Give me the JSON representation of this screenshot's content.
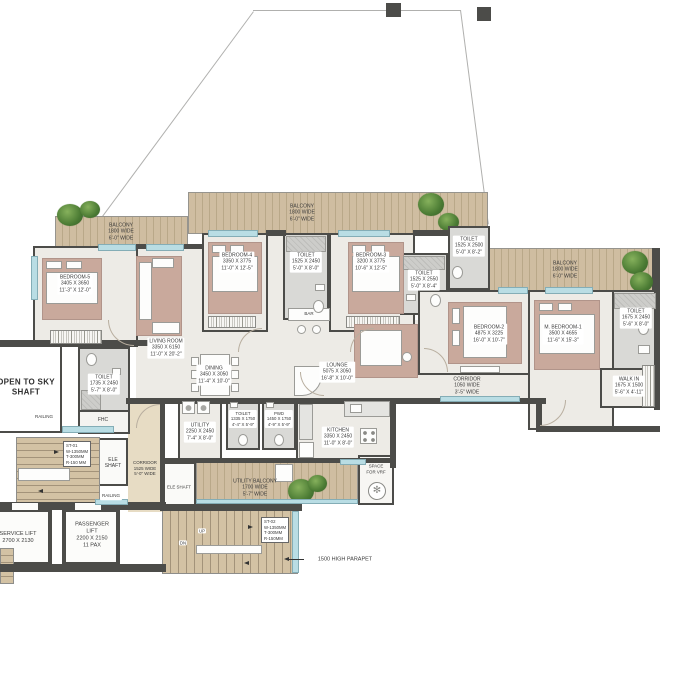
{
  "document": {
    "type": "apartment-floor-plan"
  },
  "colors": {
    "wall": "#4c4c49",
    "floor": "#edebe6",
    "tile": "#d9d9d6",
    "wood": "#cfbda1",
    "corridor_floor": "#e7dcc4",
    "furniture_rose": "#c9a99c",
    "window_glass": "#b9dde4",
    "tree_green": "#4a7a33",
    "text": "#3a3a3a"
  },
  "labels": {
    "balcony_tl": [
      "BALCONY",
      "1800 WIDE",
      "6'-0\" WIDE"
    ],
    "balcony_mid": [
      "BALCONY",
      "1800 WIDE",
      "6'-0\" WIDE"
    ],
    "balcony_r": [
      "BALCONY",
      "1800 WIDE",
      "6'-0\" WIDE"
    ],
    "bedroom5": [
      "BEDROOM-5",
      "3405 X 3650",
      "11'-3\" X 12'-0\""
    ],
    "bedroom4": [
      "BEDROOM-4",
      "3350 X 3775",
      "11'-0\" X 12'-5\""
    ],
    "bedroom3": [
      "BEDROOM-3",
      "3200 X 3775",
      "10'-6\" X 12'-5\""
    ],
    "bedroom2": [
      "BEDROOM-2",
      "4875 X 3225",
      "16'-0\" X 10'-7\""
    ],
    "mbedroom1": [
      "M. BEDROOM-1",
      "3500 X 4655",
      "11'-6\" X 15'-3\""
    ],
    "living": [
      "LIVING ROOM",
      "3350 X 6150",
      "11'-0\" X 20'-2\""
    ],
    "dining": [
      "DINING",
      "3450 X 3050",
      "11'-4\" X 10'-0\""
    ],
    "lounge": [
      "LOUNGE",
      "5075 X 3050",
      "16'-8\" X 10'-0\""
    ],
    "bar": "BAR",
    "toilet_b4": [
      "TOILET",
      "1525 X 2450",
      "5'-0\" X 8'-0\""
    ],
    "toilet_mid": [
      "TOILET",
      "1525 X 2550",
      "5'-0\" X 8'-4\""
    ],
    "toilet_b3": [
      "TOILET",
      "1525 X 2500",
      "5'-0\" X 8'-2\""
    ],
    "toilet_m": [
      "TOILET",
      "1675 X 2450",
      "5'-6\" X 8'-0\""
    ],
    "toilet_l": [
      "TOILET",
      "1735 X 2450",
      "5'-7\" X 8'-0\""
    ],
    "toilet_s": [
      "TOILET",
      "1335 X 1750",
      "4'-4\" X 5'-9\""
    ],
    "pwd": [
      "PWD",
      "1450 X 1750",
      "4'-9\" X 5'-9\""
    ],
    "walkin": [
      "WALK IN",
      "1675 X 1500",
      "5'-6\" X 4'-11\""
    ],
    "corridor_r": [
      "CORRIDOR",
      "1050 WIDE",
      "3'-5\" WIDE"
    ],
    "corridor_l": [
      "CORRIDOR",
      "1525 WIDE",
      "5'-0\" WIDE"
    ],
    "open_sky": [
      "OPEN TO SKY",
      "SHAFT"
    ],
    "fhc": "FHC",
    "railing_top": "RAILING",
    "railing_bottom": "RAILING",
    "ele_shaft_core": [
      "ELE",
      "SHAFT"
    ],
    "ele_shaft_balcony": "ELE SHAFT",
    "st01": [
      "ST-01",
      "W-1350MM",
      "T-300MM",
      "R-150 MM"
    ],
    "st02": [
      "ST-02",
      "W-1350MM",
      "T-300MM",
      "R-150MM"
    ],
    "passenger_lift": [
      "PASSENGER",
      "LIFT",
      "2200 X 2150",
      "11 PAX"
    ],
    "service_lift": [
      "SERVICE LIFT",
      "2700 X 2130"
    ],
    "utility": [
      "UTILITY",
      "2250 X 2450",
      "7'-4\" X 8'-0\""
    ],
    "kitchen": [
      "KITCHEN",
      "3350 X 2450",
      "11'-0\" X 8'-0\""
    ],
    "utility_balcony": [
      "UTILITY BALCONY",
      "1700 WIDE",
      "5'-7\" WIDE"
    ],
    "vrf": [
      "SPACE",
      "FOR VRF"
    ],
    "up": "UP",
    "dn": "DN",
    "parapet_note": "1500 HIGH PARAPET"
  }
}
